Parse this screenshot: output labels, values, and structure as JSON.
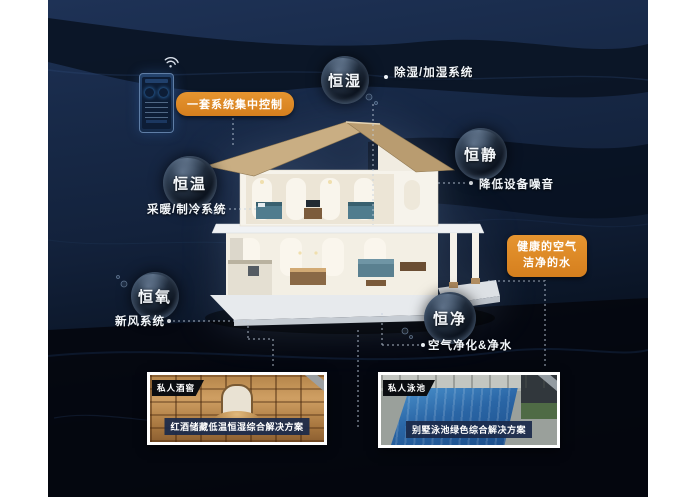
{
  "colors": {
    "accent_orange": "#d98420",
    "background_navy": "#13223c",
    "caption_bar_navy": "#1b2a4a",
    "bubble_dark": "#0c131e"
  },
  "control_panel": {
    "label": "一套系统集中控制"
  },
  "bubbles": {
    "humidity": {
      "label": "恒湿",
      "annotation": "除湿/加湿系统"
    },
    "quiet": {
      "label": "恒静",
      "annotation": "降低设备噪音"
    },
    "temperature": {
      "label": "恒温",
      "annotation": "采暖/制冷系统"
    },
    "oxygen": {
      "label": "恒氧",
      "annotation": "新风系统"
    },
    "purity": {
      "label": "恒净",
      "annotation": "空气净化&净水"
    }
  },
  "callout_box": {
    "line1": "健康的空气",
    "line2": "洁净的水"
  },
  "photos": {
    "wine_cellar": {
      "tag": "私人酒窖",
      "caption": "红酒储藏低温恒湿综合解决方案"
    },
    "pool": {
      "tag": "私人泳池",
      "caption": "别墅泳池绿色综合解决方案"
    }
  }
}
